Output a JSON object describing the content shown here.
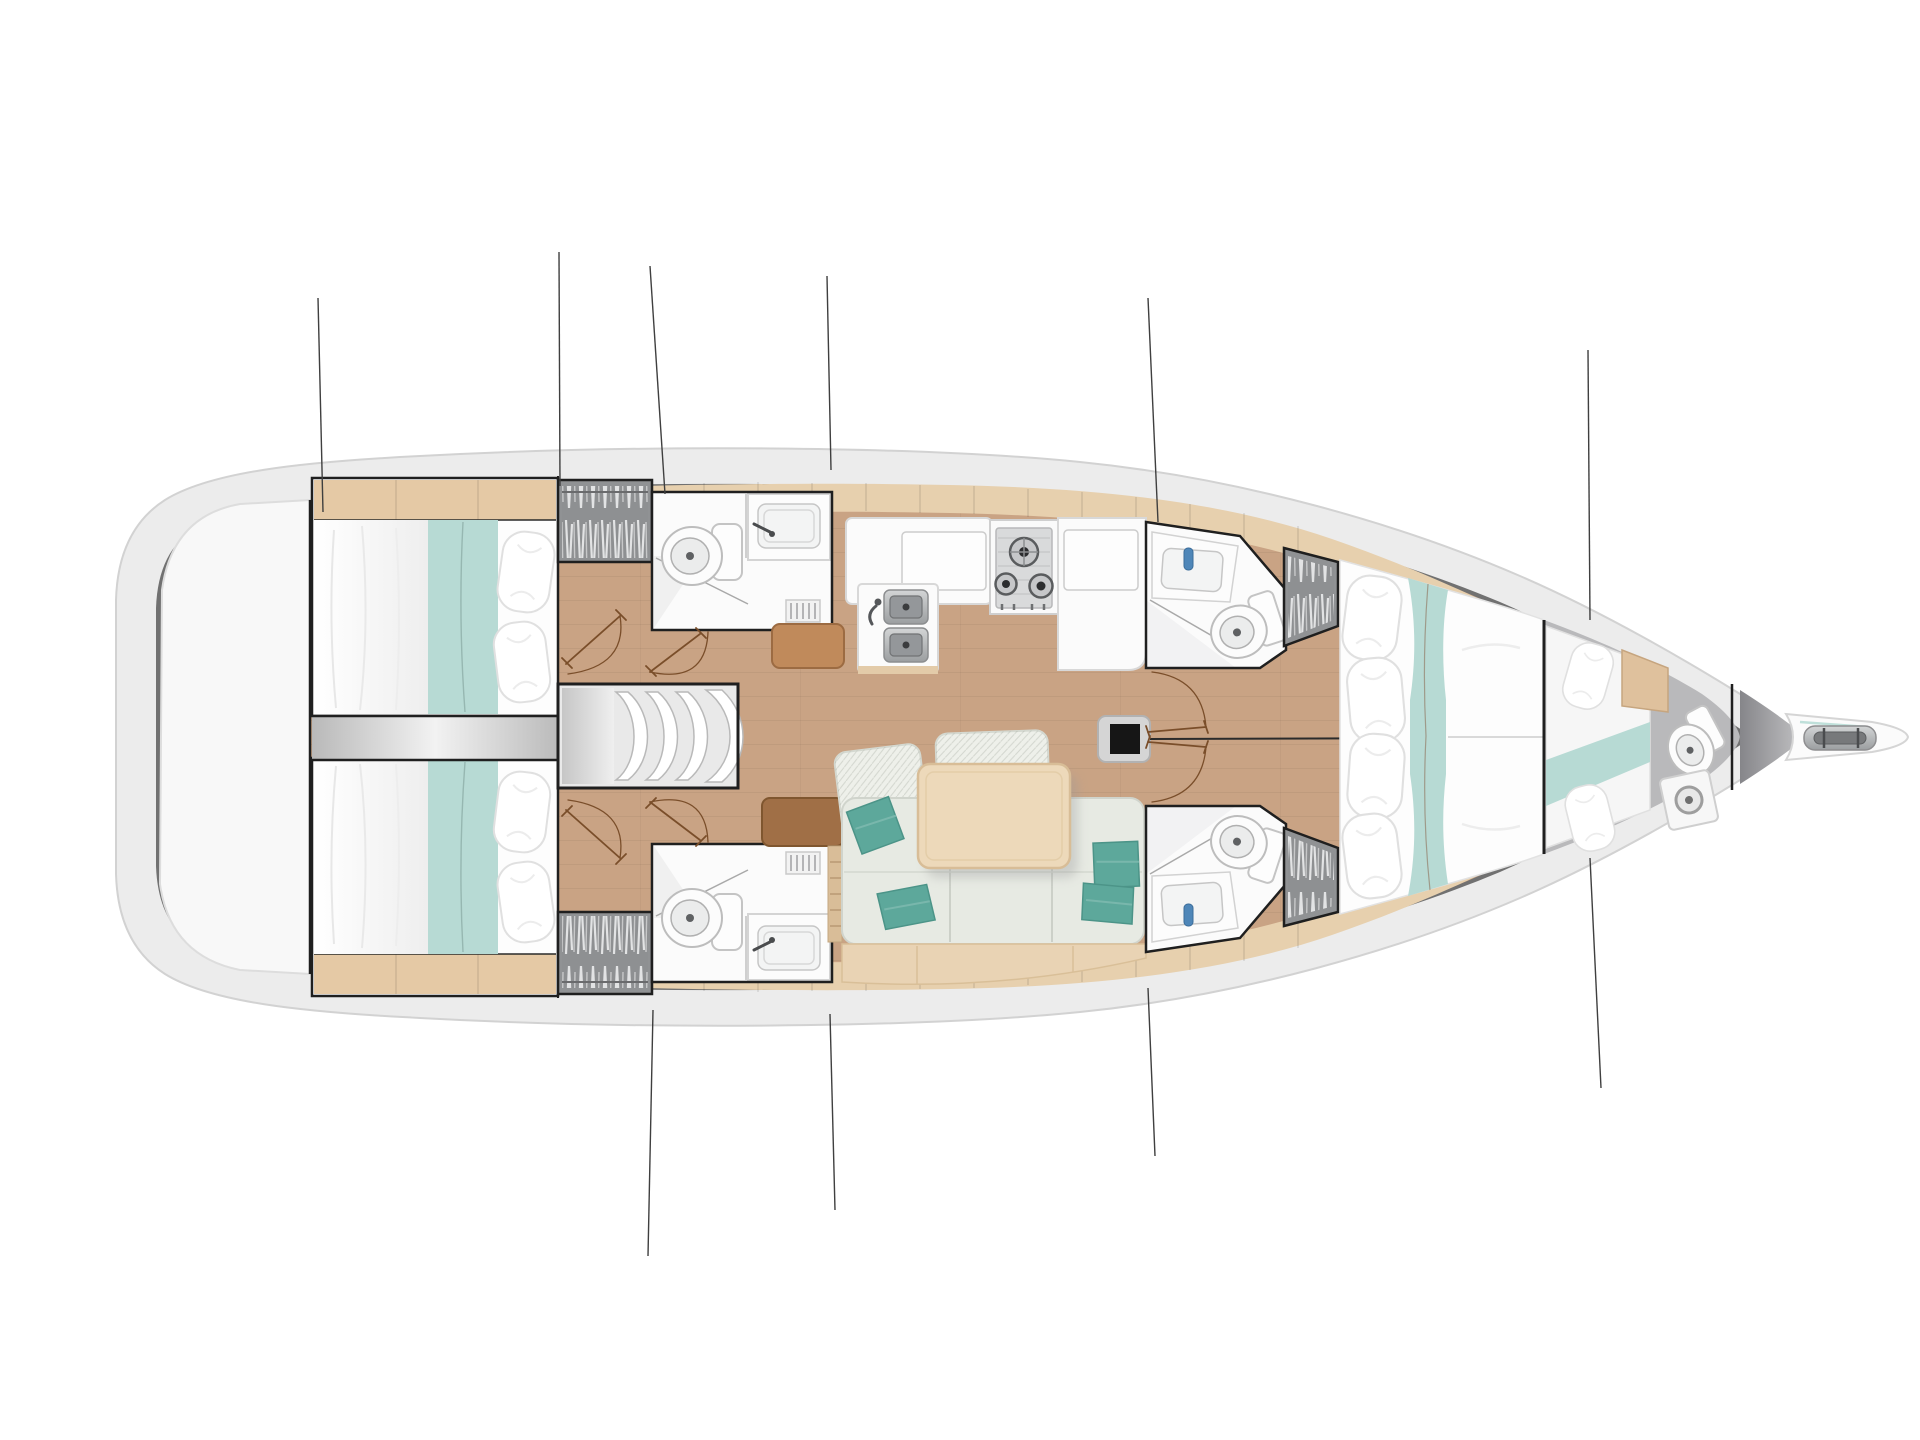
{
  "meta": {
    "title": "Sailboat interior deck plan, top-down view, bow to the right",
    "view": "top-down floor plan"
  },
  "colors": {
    "background": "#ffffff",
    "hull": "#ececec",
    "hull_stroke": "#d2d2d2",
    "deck_band": "#717171",
    "transom": "#f8f8f8",
    "floor_wood": "#c9a384",
    "trim_wood": "#e7d0ae",
    "shelf_wood": "#e5c9a5",
    "wall": "#1f1f1f",
    "room_white": "#fbfbfb",
    "locker_gray": "#909294",
    "bed_white": "#fdfdfd",
    "teal_runner": "#b7dad4",
    "teal_pillow": "#5da89b",
    "sofa": "#e7eae3",
    "sofa_back": "#eef0ea",
    "sofa_trim": "#e9d3b4",
    "table": "#edd9ba",
    "seat_brown_light": "#c08a5b",
    "seat_brown_dark": "#a06f46",
    "stove_panel": "#d9dadb",
    "engine_strip": "#d9d9d9",
    "door_brown": "#7a4e2a",
    "mast": "#161616",
    "rigging": "#3f3f3f",
    "bow_floor": "#9a9a9c",
    "wood_panel": "#dfc19d",
    "soap_blue": "#4e86b8"
  },
  "areas": {
    "hull": {
      "label": "sailboat hull, bow pointing right"
    },
    "transom": {
      "label": "stern swim platform and transom locker"
    },
    "aft_cabin_port": {
      "label": "aft port double-berth cabin"
    },
    "aft_cabin_starboard": {
      "label": "aft starboard double-berth cabin"
    },
    "engine": {
      "label": "engine compartment between aft cabins"
    },
    "companionway": {
      "label": "companionway entry steps"
    },
    "aft_head_port": {
      "label": "aft port head with toilet and sink"
    },
    "aft_head_starboard": {
      "label": "aft starboard head with toilet and sink"
    },
    "wardrobe_aft_port": {
      "label": "hanging wardrobe locker aft port"
    },
    "wardrobe_aft_starboard": {
      "label": "hanging wardrobe locker aft starboard"
    },
    "galley": {
      "label": "galley with double sink, three-burner stove and refrigerator counters"
    },
    "salon": {
      "label": "salon with L-shaped settee, cushions and dining table"
    },
    "mast": {
      "label": "mast foot on centerline"
    },
    "fwd_head_port": {
      "label": "forward port head with sink and toilet"
    },
    "fwd_head_starboard": {
      "label": "forward starboard head with sink and toilet"
    },
    "wardrobe_fwd_port": {
      "label": "hanging wardrobe locker forward port"
    },
    "wardrobe_fwd_starboard": {
      "label": "hanging wardrobe locker forward starboard"
    },
    "owner_cabin": {
      "label": "forward owner cabin with island double berth"
    },
    "forepeak": {
      "label": "fore-peak crew berth with toilet"
    },
    "bowsprit": {
      "label": "bowsprit with anchor roller"
    },
    "rigging": {
      "label": "standing rigging shroud and stay lines"
    }
  },
  "counts": {
    "cabins": 3,
    "heads": 4,
    "crew_berths": 1,
    "stove_burners": 3,
    "galley_sinks": 2,
    "companionway_steps": 4,
    "salon_teal_cushions": 4,
    "owner_bed_pillows": 4,
    "rigging_lines": 10
  }
}
